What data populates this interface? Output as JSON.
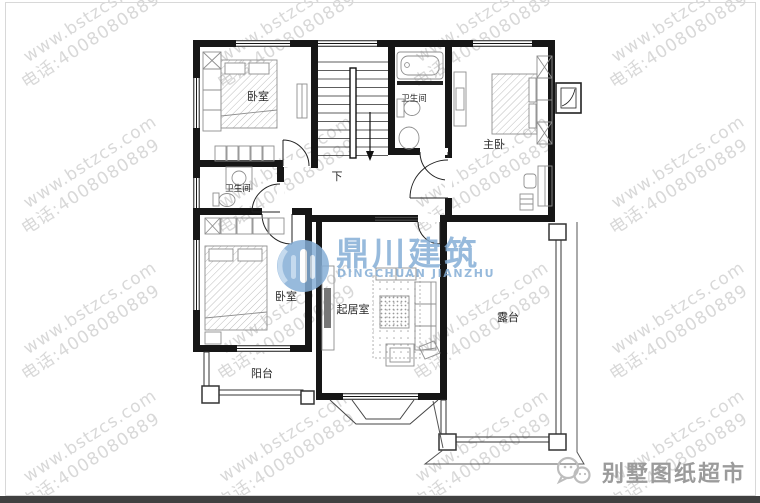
{
  "watermark": {
    "line1": "www.bstzcs.com",
    "line2": "电话:4008080889",
    "color": "#c9c9c9",
    "rotation_deg": -33
  },
  "logo": {
    "cn": "鼎川建筑",
    "en": "DINGCHUAN JIANZHU",
    "color": "#85aed6"
  },
  "floor_plan": {
    "rooms": [
      {
        "id": "bedroom-top-left",
        "label": "卧室"
      },
      {
        "id": "bathroom-top",
        "label": "卫生间"
      },
      {
        "id": "master-bedroom",
        "label": "主卧"
      },
      {
        "id": "bathroom-middle",
        "label": "卫生间"
      },
      {
        "id": "bedroom-bottom-left",
        "label": "卧室"
      },
      {
        "id": "living-room",
        "label": "起居室"
      },
      {
        "id": "terrace",
        "label": "露台"
      },
      {
        "id": "balcony",
        "label": "阳台"
      }
    ],
    "stair_label": "下"
  },
  "footer": {
    "brand": "别墅图纸超市",
    "bar_color": "#404040"
  }
}
